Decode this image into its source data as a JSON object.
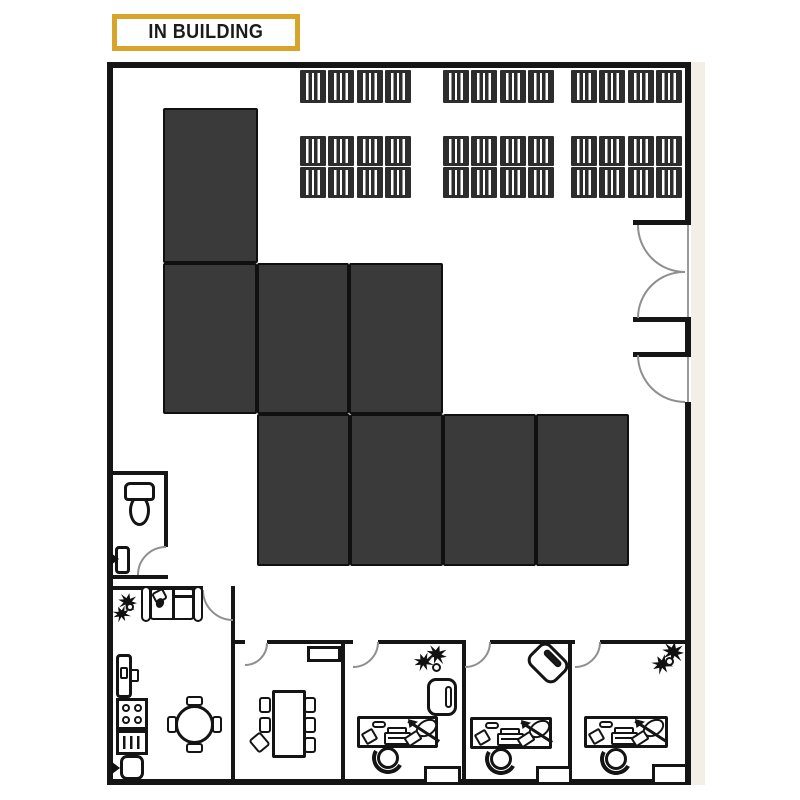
{
  "header": {
    "label": "IN BUILDING"
  },
  "colors": {
    "accent_gold": "#D8A42A",
    "wall_black": "#151515",
    "blocked_zone_fill": "#3A3A3A",
    "door_arc_gray": "#8F8F8F",
    "outside_shadow": "#F3EFE6"
  },
  "floorplan": {
    "blocked_zones": {
      "count": 8,
      "description": "dark gray blocked rectangles in warehouse area"
    },
    "storage_racks": {
      "top_row_groups": 3,
      "double_row_groups": 3,
      "pallets_per_group": 4
    },
    "doors": [
      "right-wall-double-door",
      "right-wall-single-door",
      "bathroom-door",
      "lounge-door",
      "meeting-room-door",
      "office-1-door",
      "office-2-door",
      "office-3-door"
    ],
    "rooms": [
      {
        "name": "bathroom",
        "furniture": [
          "toilet",
          "wall-sink"
        ]
      },
      {
        "name": "lounge",
        "furniture": [
          "sofa",
          "plant"
        ]
      },
      {
        "name": "kitchen",
        "furniture": [
          "fridge",
          "stove-4-burners",
          "vent-drawer",
          "sink",
          "round-table",
          "4-chairs"
        ]
      },
      {
        "name": "meeting-room",
        "furniture": [
          "conference-table",
          "6-chairs",
          "credenza"
        ]
      },
      {
        "name": "office-1",
        "furniture": [
          "desk",
          "desk-chair",
          "armchair",
          "plant"
        ]
      },
      {
        "name": "office-2",
        "furniture": [
          "desk",
          "desk-chair",
          "armchair-rotated"
        ]
      },
      {
        "name": "office-3",
        "furniture": [
          "desk",
          "desk-chair",
          "plant"
        ]
      }
    ]
  }
}
